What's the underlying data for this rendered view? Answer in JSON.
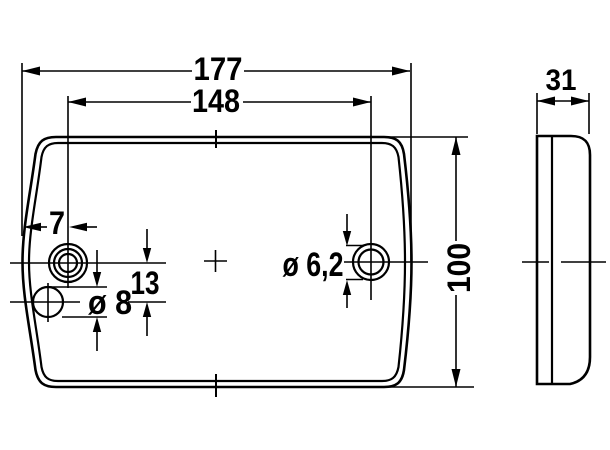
{
  "colors": {
    "ink": "#000000",
    "background": "#ffffff"
  },
  "dimensions": {
    "overall_width": "177",
    "hole_spacing": "148",
    "depth": "31",
    "overall_height": "100",
    "hole_edge_offset": "7",
    "hole_vertical_offset": "13",
    "large_hole_diameter": "ø 8",
    "small_hole_diameter": "ø 6,2"
  }
}
